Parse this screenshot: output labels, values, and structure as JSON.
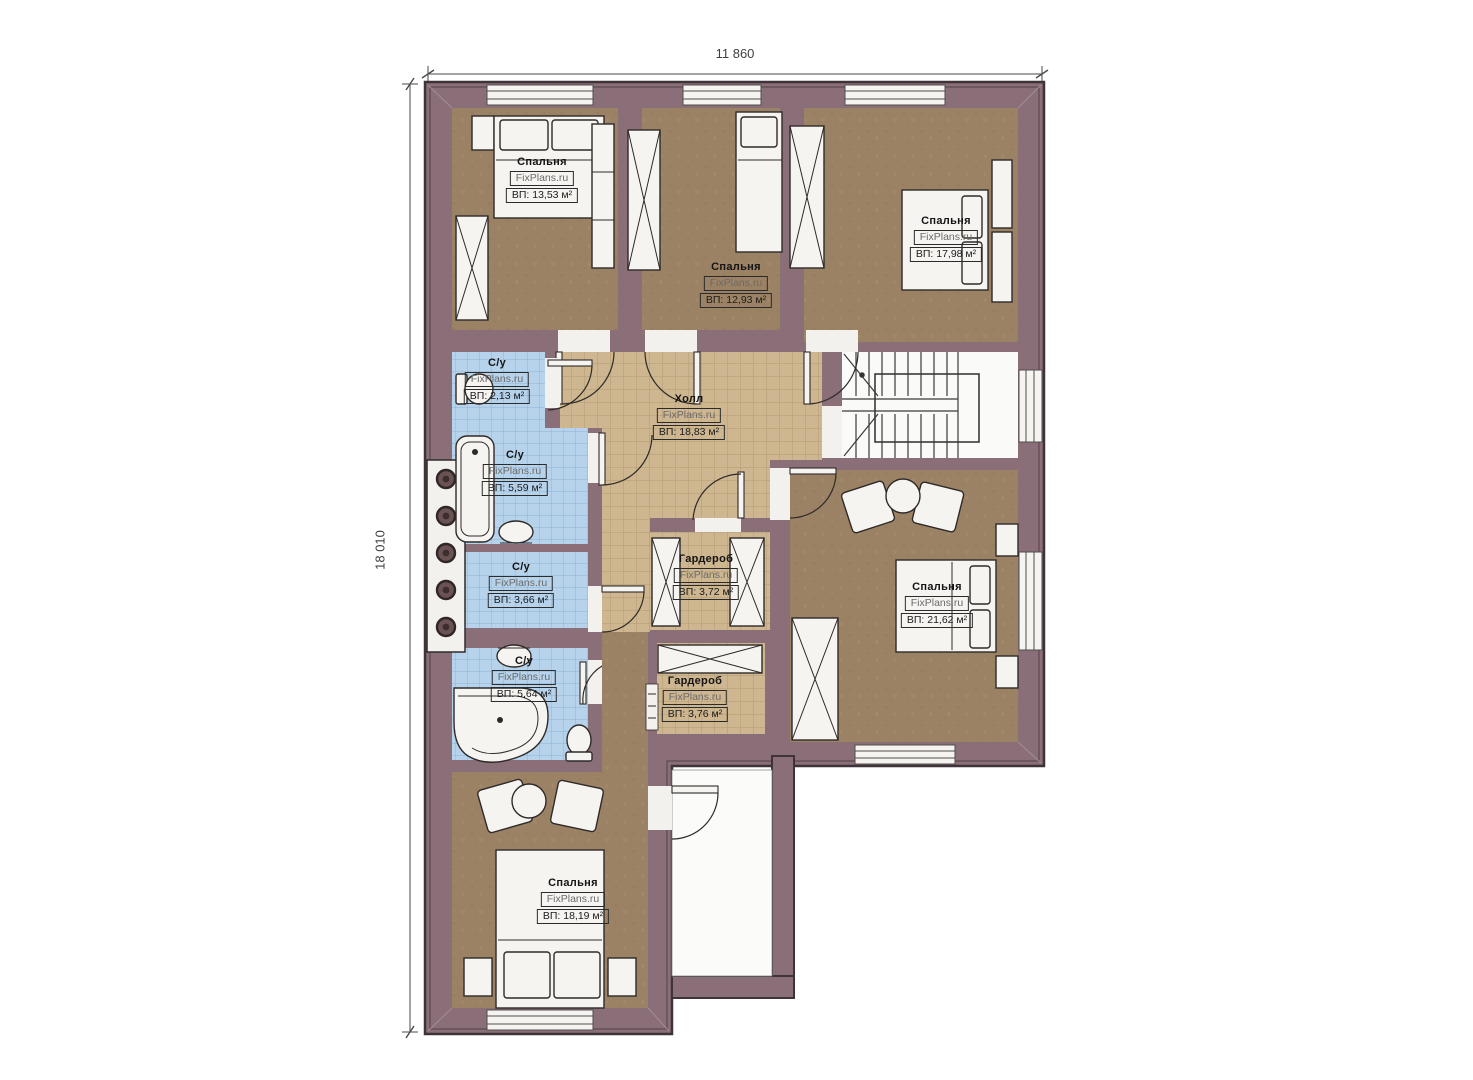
{
  "dimensions": {
    "width": "11 860",
    "height": "18 010"
  },
  "brand": "FixPlans.ru",
  "rooms": [
    {
      "id": "bedroom-top-left",
      "name": "Спальня",
      "area": "ВП: 13,53 м²"
    },
    {
      "id": "bedroom-top-middle",
      "name": "Спальня",
      "area": "ВП: 12,93 м²"
    },
    {
      "id": "bedroom-top-right",
      "name": "Спальня",
      "area": "ВП: 17,98 м²"
    },
    {
      "id": "wc-small",
      "name": "С/у",
      "area": "ВП: 2,13 м²"
    },
    {
      "id": "hall",
      "name": "Холл",
      "area": "ВП: 18,83 м²"
    },
    {
      "id": "bathroom-main",
      "name": "С/у",
      "area": "ВП: 5,59 м²"
    },
    {
      "id": "wc-middle",
      "name": "С/у",
      "area": "ВП: 3,66 м²"
    },
    {
      "id": "wardrobe-upper",
      "name": "Гардероб",
      "area": "ВП: 3,72 м²"
    },
    {
      "id": "bedroom-right",
      "name": "Спальня",
      "area": "ВП: 21,62 м²"
    },
    {
      "id": "bathroom-lower",
      "name": "С/у",
      "area": "ВП: 5,64 м²"
    },
    {
      "id": "wardrobe-lower",
      "name": "Гардероб",
      "area": "ВП: 3,76 м²"
    },
    {
      "id": "bedroom-bottom",
      "name": "Спальня",
      "area": "ВП: 18,19 м²"
    }
  ],
  "colors": {
    "wall": "#8a6e78",
    "wall_outline": "#3e3338",
    "bedroom_floor": "#9c8264",
    "hall_tile": "#cdb690",
    "hall_tile_line": "#b2996f",
    "wet_tile": "#b7d3eb",
    "wet_tile_line": "#8cb4d6",
    "fixture_white": "#f5f4f1",
    "balcony_floor": "#fbfbfa"
  }
}
